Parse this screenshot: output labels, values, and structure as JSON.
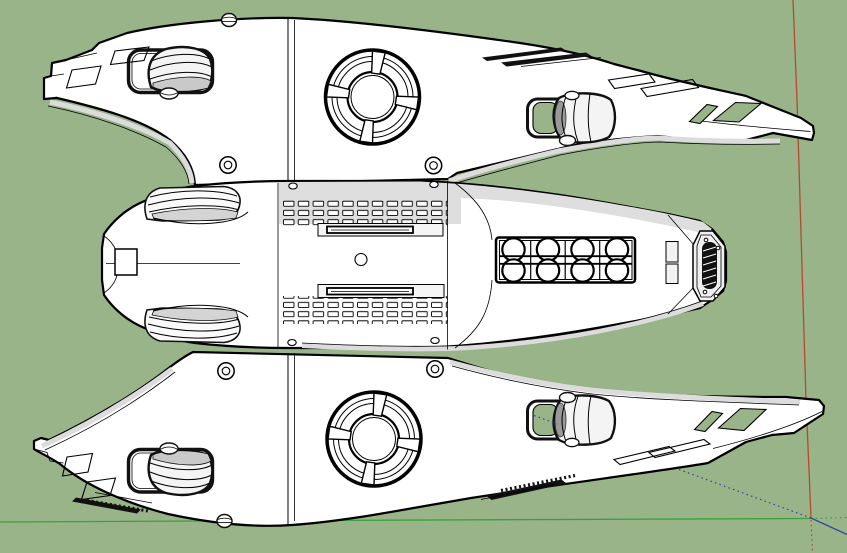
{
  "scene": {
    "description": "3D modeling viewport (SketchUp-style) showing the top view of a white spacecraft model over a plain green background, with drawing axes at lower right",
    "background_color": "#99B489",
    "model": {
      "label": "spacecraft-top-view",
      "surface_color": "#FFFFFF",
      "shade_color": "#DEDEDE",
      "edge_color": "#000000",
      "parts": [
        "upper-wing",
        "lower-wing",
        "fuselage",
        "turret-upper",
        "turret-lower",
        "engine-pod-upper-left",
        "engine-pod-upper-right",
        "engine-pod-lower-left",
        "engine-pod-lower-right",
        "intake-upper",
        "intake-lower",
        "vent-grid-top",
        "vent-grid-bottom",
        "cockpit-ports-panel",
        "tail-exhaust-plate",
        "nose-hatch"
      ]
    },
    "axes": {
      "origin_px": {
        "x": 811,
        "y": 518
      },
      "red": {
        "color": "#B5492F",
        "solid": "upward from origin",
        "dotted": "downward from origin"
      },
      "green": {
        "color": "#3BA23B",
        "solid": "leftward from origin",
        "dotted": "rightward from origin"
      },
      "blue": {
        "color": "#35479E",
        "solid": "down-right from origin",
        "dotted": "up-left from origin"
      }
    }
  }
}
